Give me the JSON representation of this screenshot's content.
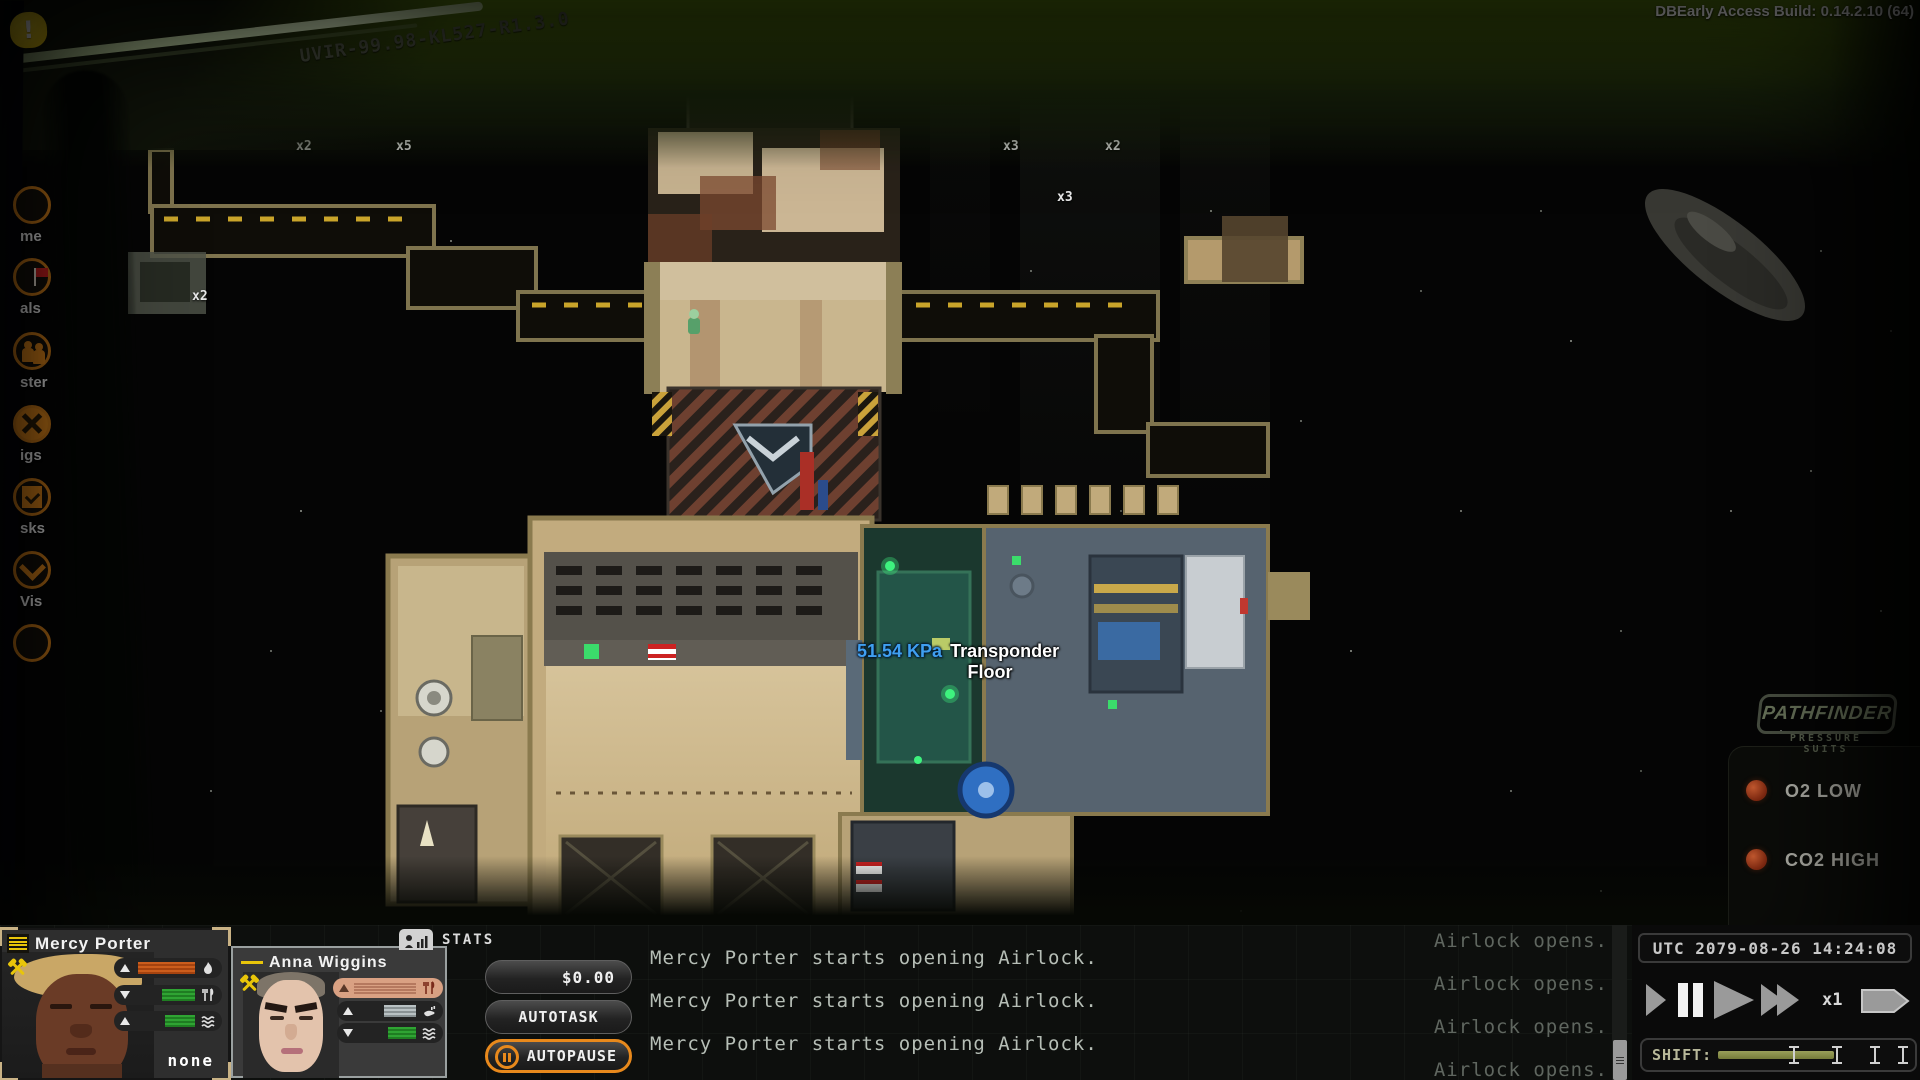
{
  "window": {
    "build_label": "DBEarly Access Build: 0.14.2.10 (64)"
  },
  "scene": {
    "station_label": "UVIR-99.98-KL527-R1.3.0",
    "tooltip": {
      "pressure": "51.54 KPa",
      "object_line1": "Transponder",
      "object_line2": "Floor"
    },
    "stack_counts": [
      "x2",
      "x5",
      "x3",
      "x2",
      "x3",
      "x2"
    ]
  },
  "sidebar": {
    "items": [
      {
        "label": "me",
        "icon": "menu-icon"
      },
      {
        "label": "als",
        "icon": "flag-icon"
      },
      {
        "label": "ster",
        "icon": "crew-icon"
      },
      {
        "label": "igs",
        "icon": "wrench-x-icon"
      },
      {
        "label": "sks",
        "icon": "clipboard-check-icon"
      },
      {
        "label": "Vis",
        "icon": "chevron-down-icon"
      }
    ]
  },
  "suit_hud": {
    "brand": "PATHFINDER",
    "brand_sub": "PRESSURE SUITS",
    "warnings": [
      "O2 LOW",
      "CO2 HIGH"
    ]
  },
  "crew_panel": {
    "stats_tab": "STATS",
    "money_button": "$0.00",
    "autotask_button": "AUTOTASK",
    "autopause_button": "AUTOPAUSE",
    "crew": [
      {
        "name": "Mercy Porter",
        "status": "none",
        "bars": [
          {
            "trend": "up",
            "icon": "flame-icon",
            "fill_pct": 95,
            "fill_color": "#c2581a"
          },
          {
            "trend": "down",
            "icon": "utensils-icon",
            "fill_pct": 55,
            "fill_color": "#2fa433"
          },
          {
            "trend": "up",
            "icon": "waves-icon",
            "fill_pct": 50,
            "fill_color": "#2fa433"
          }
        ]
      },
      {
        "name": "Anna Wiggins",
        "bars": [
          {
            "trend": "up",
            "icon": "utensils-icon",
            "fill_pct": 100,
            "fill_color": "#d9a183",
            "highlighted": true
          },
          {
            "trend": "up",
            "icon": "hand-icon",
            "fill_pct": 55,
            "fill_color": "#b9c1c3"
          },
          {
            "trend": "down",
            "icon": "waves-icon",
            "fill_pct": 48,
            "fill_color": "#2fa433"
          }
        ]
      }
    ]
  },
  "log": {
    "messages_left": [
      "Mercy Porter starts opening Airlock.",
      "Mercy Porter starts opening Airlock.",
      "Mercy Porter starts opening Airlock."
    ],
    "messages_right": [
      "Airlock opens.",
      "Airlock opens.",
      "Airlock opens.",
      "Airlock opens."
    ]
  },
  "time_panel": {
    "utc": "UTC 2079-08-26 14:24:08",
    "speed": "x1",
    "shift_label": "SHIFT:"
  },
  "colors": {
    "accent_orange": "#e8891c",
    "warning_yellow": "#e8c50a",
    "pressure_blue": "#3f9ff0",
    "visor_green": "#40590d"
  }
}
